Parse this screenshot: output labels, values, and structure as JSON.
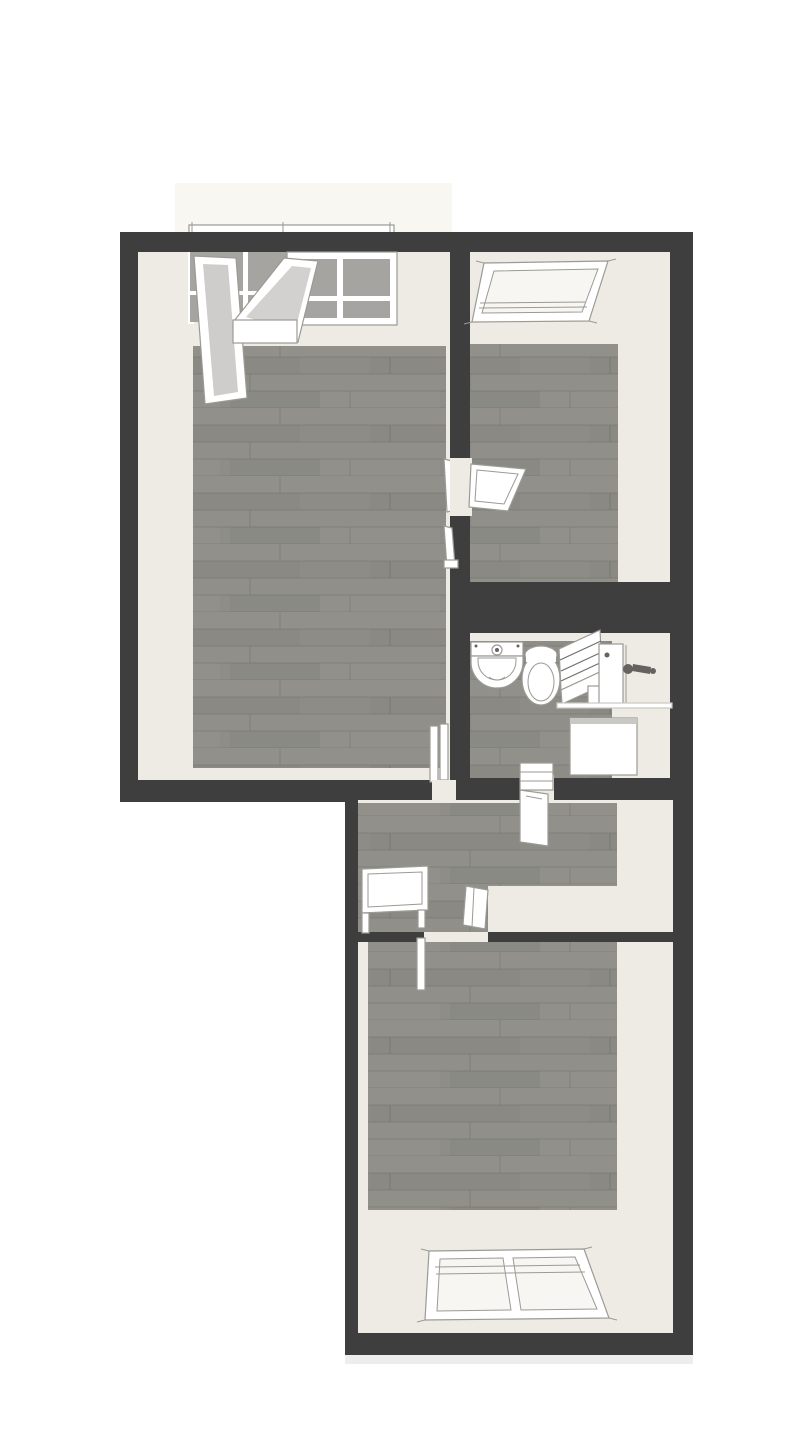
{
  "colors": {
    "outside": "#ffffff",
    "wall": "#3f3e3e",
    "room": "#edebe4",
    "room-bright": "#f7f6f2",
    "balcony": "#f8f7f2",
    "floor": "#8e8d88",
    "floor-light": "#a6a59e",
    "floor-dark": "#7b7a73",
    "glass": "#a5a4a0",
    "glass-light": "#c9c8c4",
    "fixture": "#ffffff",
    "line": "#9b9a94",
    "line-dark": "#6f6e6a",
    "metal": "#64635f"
  },
  "floorplan": {
    "rooms": [
      {
        "id": "room-top-left",
        "floor": "wood",
        "features": [
          "french-window",
          "open-window-sash",
          "tilted-window-sash",
          "interior-door"
        ]
      },
      {
        "id": "room-top-right",
        "floor": "wood",
        "features": [
          "roof-window",
          "interior-door"
        ]
      },
      {
        "id": "bathroom",
        "floor": "wood",
        "features": [
          "sink",
          "toilet",
          "slatted-panel",
          "wall-door",
          "shower-fixture",
          "white-appliance",
          "door-threshold"
        ]
      },
      {
        "id": "hallway",
        "floor": "wood",
        "features": [
          "side-table",
          "door-threshold",
          "bathroom-door-leaf"
        ]
      },
      {
        "id": "room-bottom",
        "floor": "wood",
        "features": [
          "double-roof-window",
          "interior-door-leaf"
        ]
      }
    ],
    "exterior": [
      "balcony-strip",
      "window-sill"
    ]
  }
}
